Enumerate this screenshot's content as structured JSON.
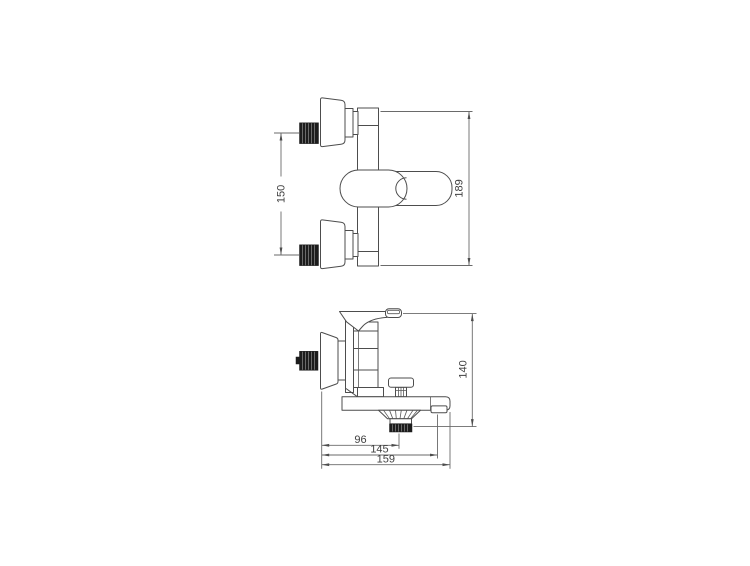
{
  "page": {
    "background_color": "#ffffff"
  },
  "drawing": {
    "line_color": "#4d4d4d",
    "text_color": "#3f3f3f",
    "thread_color": "#1c1c1c",
    "dimensions": {
      "front_inlet_spacing": "150",
      "front_overall_height": "189",
      "side_overall_height": "140",
      "side_wall_to_shower_outlet": "96",
      "side_wall_to_aerator": "145",
      "side_wall_to_spout_end": "159"
    }
  }
}
